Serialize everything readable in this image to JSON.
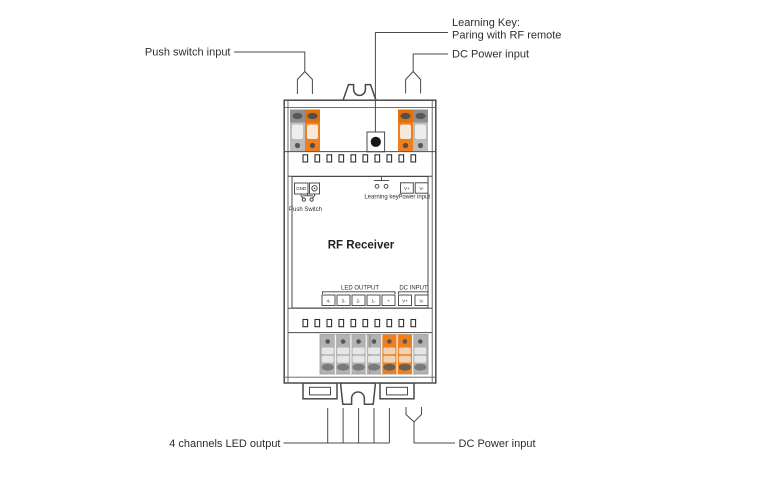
{
  "title": "RF receiver wiring diagram",
  "colors": {
    "orange": "#EE7F1E",
    "line": "#4A4A4A",
    "text": "#2E2E2E",
    "terminal_gray": "#BCBCBC"
  },
  "callouts": {
    "push_switch_input": "Push switch input",
    "learning_key_line1": "Learning Key:",
    "learning_key_line2": "Paring with RF remote",
    "dc_power_top": "DC Power input",
    "led_output_bottom": "4 channels LED output",
    "dc_power_bottom": "DC Power input"
  },
  "device": {
    "model_label": "RF Receiver",
    "panel": {
      "gnd_label": "GND",
      "push_switch_label": "Push Switch",
      "learning_key_label": "Learning key",
      "power_input_label": "Power input",
      "power_terminals": [
        "V+",
        "V-"
      ],
      "led_output_label": "LED OUTPUT",
      "dc_input_label": "DC INPUT",
      "output_terminals": [
        "4-",
        "3-",
        "2-",
        "1-",
        "+",
        "V+",
        "V-"
      ]
    }
  }
}
